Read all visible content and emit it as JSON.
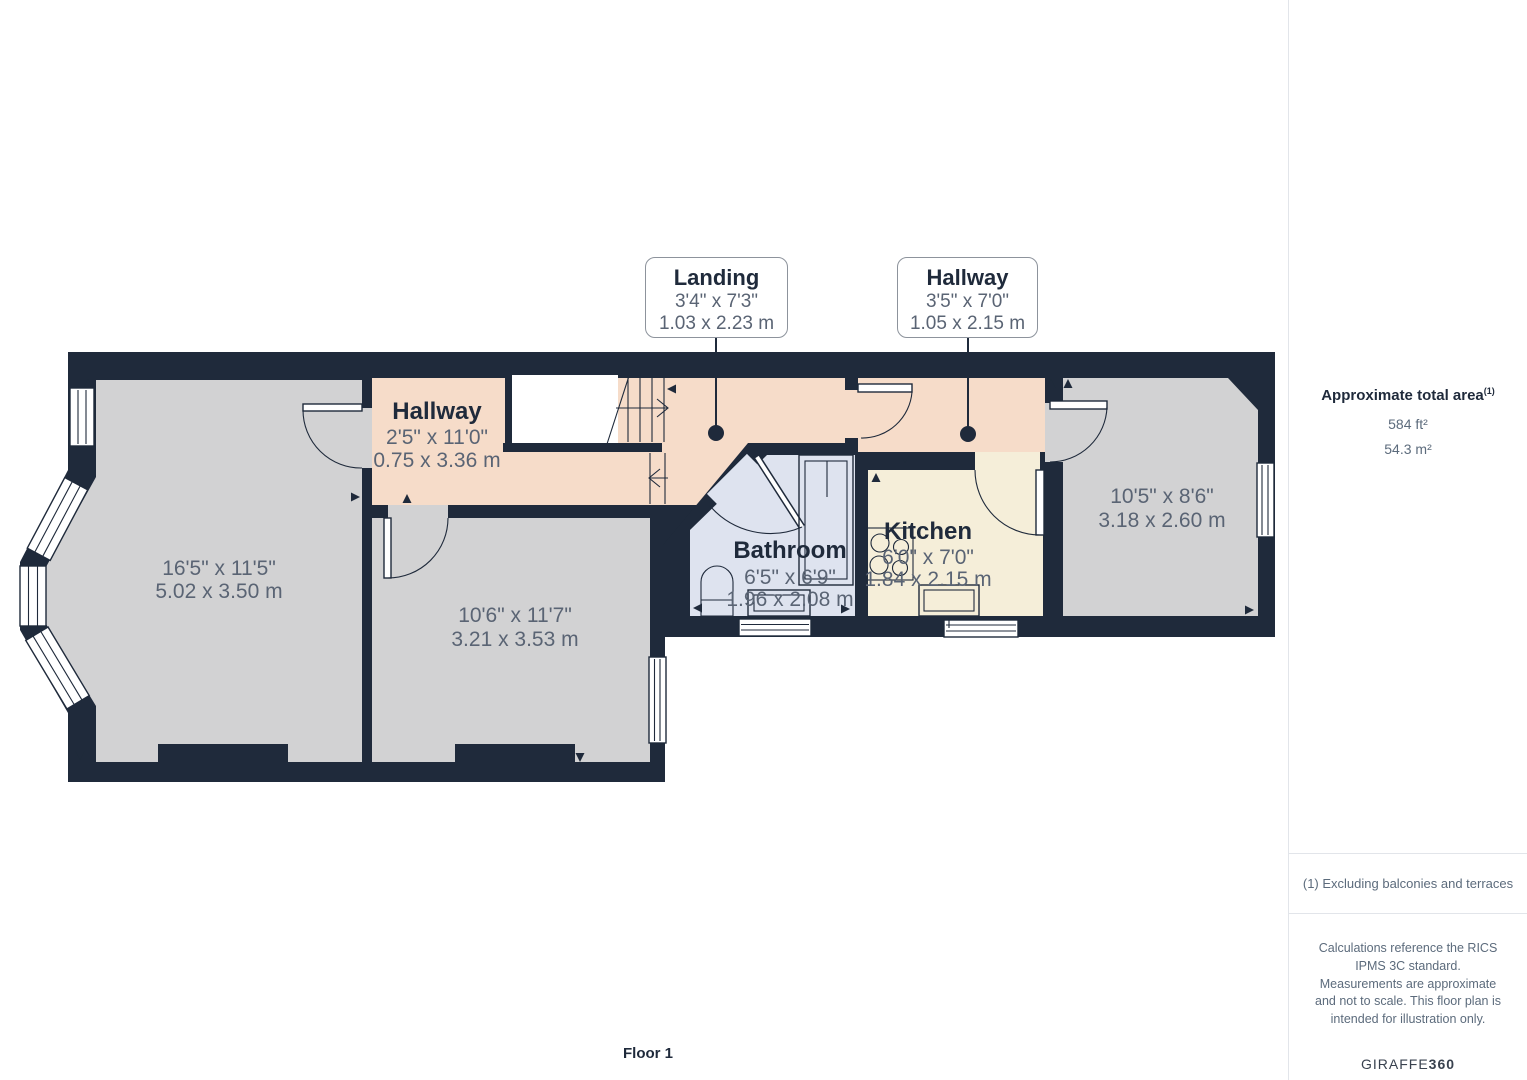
{
  "plan": {
    "floor_label": "Floor 1",
    "callouts": {
      "landing": {
        "title": "Landing",
        "dims_ft": "3'4\" x 7'3\"",
        "dims_m": "1.03 x 2.23 m"
      },
      "hallway": {
        "title": "Hallway",
        "dims_ft": "3'5\" x 7'0\"",
        "dims_m": "1.05 x 2.15 m"
      }
    },
    "rooms": {
      "room_left": {
        "dims_ft": "16'5\" x 11'5\"",
        "dims_m": "5.02 x 3.50 m"
      },
      "room_middle": {
        "dims_ft": "10'6\" x 11'7\"",
        "dims_m": "3.21 x 3.53 m"
      },
      "hallway": {
        "name": "Hallway",
        "dims_ft": "2'5\" x 11'0\"",
        "dims_m": "0.75 x 3.36 m"
      },
      "bathroom": {
        "name": "Bathroom",
        "dims_ft": "6'5\" x 6'9\"",
        "dims_m": "1.96 x 2.08 m"
      },
      "kitchen": {
        "name": "Kitchen",
        "dims_ft": "6'0\" x 7'0\"",
        "dims_m": "1.84 x 2.15 m"
      },
      "room_right": {
        "dims_ft": "10'5\" x 8'6\"",
        "dims_m": "3.18 x 2.60 m"
      }
    }
  },
  "sidebar": {
    "area_title": "Approximate total area",
    "area_footnote_marker": "(1)",
    "area_imperial": "584 ft²",
    "area_metric": "54.3 m²",
    "footnote": "(1) Excluding balconies and terraces",
    "disclaimer": "Calculations reference the RICS IPMS 3C standard. Measurements are approximate and not to scale. This floor plan is intended for illustration only.",
    "brand_prefix": "GIRAFFE",
    "brand_suffix": "360"
  },
  "colors": {
    "wall": "#1f2a3b",
    "room-gray": "#d2d2d3",
    "room-peach": "#f6dcc9",
    "room-blue": "#dee3ef",
    "room-cream": "#f5eed9",
    "dim-text": "#5a6474",
    "name-text": "#1f2a3b",
    "callout-border": "#8d939c",
    "sidebar-border": "#e2e5ea",
    "sidebar-heading": "#1f2a3b",
    "sidebar-text": "#5c6b7c",
    "brand-text": "#39424f"
  }
}
